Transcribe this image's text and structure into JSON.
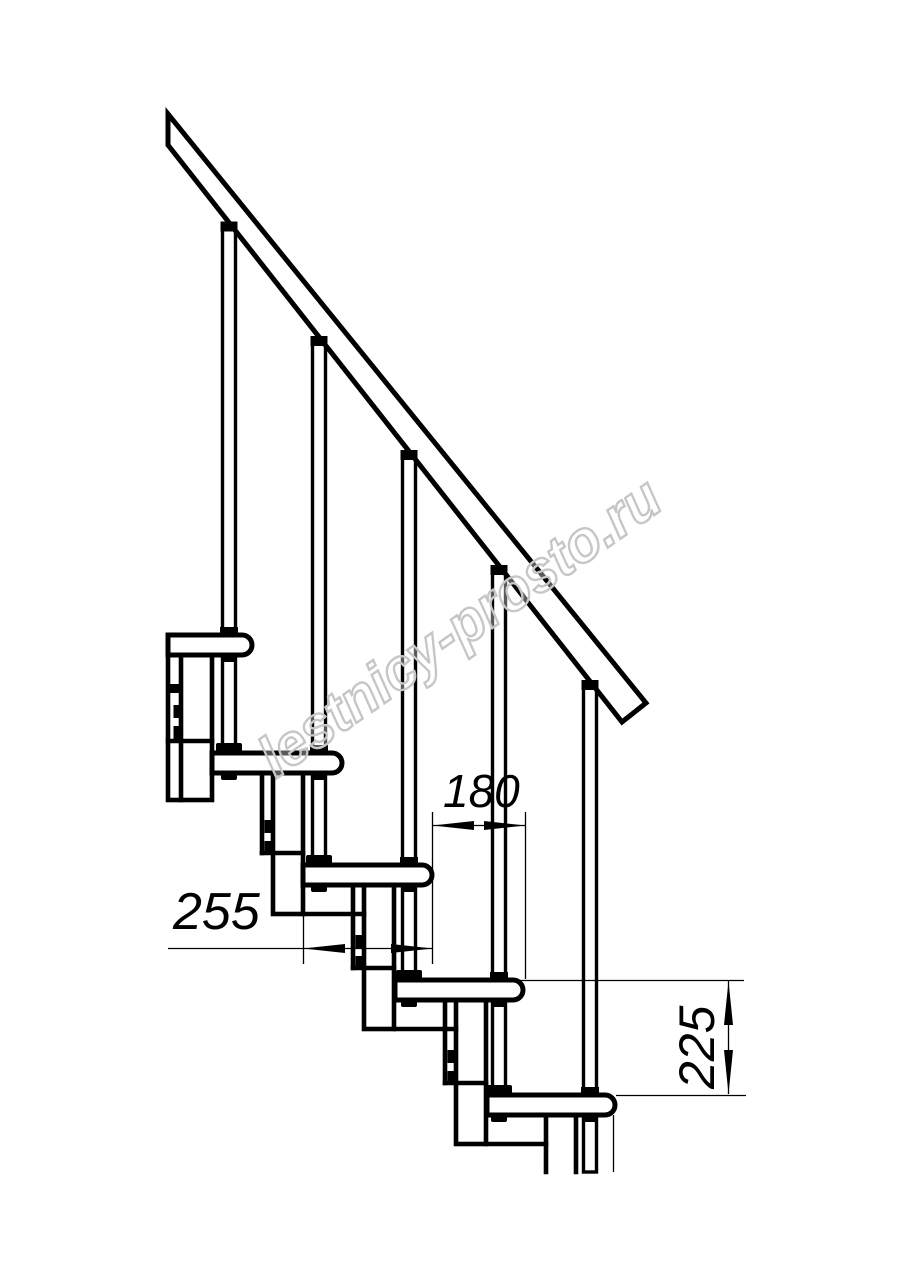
{
  "drawing": {
    "background_color": "#ffffff",
    "line_color": "#000000",
    "treads_visible": 5,
    "balusters_visible": 5,
    "dimensions": {
      "tread_depth": "255",
      "step_run": "180",
      "step_rise": "225"
    },
    "watermark": {
      "text": "lestnicy-prosto.ru",
      "color": "#c6c6c6"
    }
  }
}
